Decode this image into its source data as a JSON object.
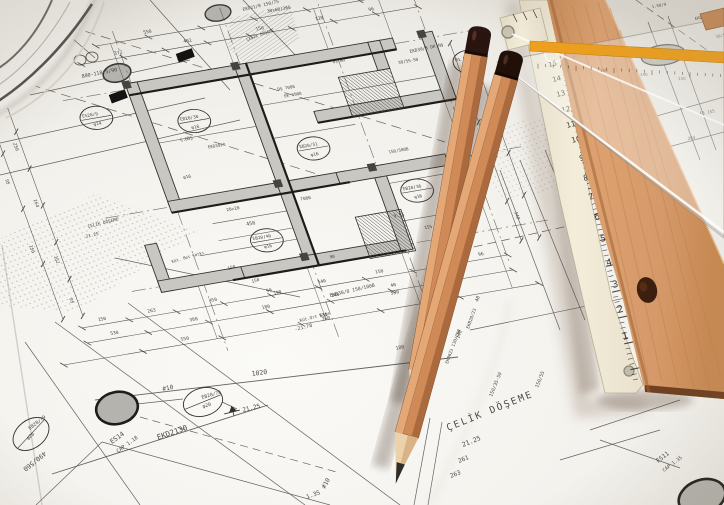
{
  "scene": {
    "type": "photograph",
    "subject": "architectural structural blueprint (Turkish) with two wooden pencils, a folding rule, a wooden straightedge and a transparent set square with yellow stripe"
  },
  "colors": {
    "paper": "#f5f3ef",
    "ink": "#3a3835",
    "wall_fill": "#c9c7c2",
    "column_fill": "#b9b7b1",
    "pencil_wood": "#cf8a57",
    "pencil_cap": "#261310",
    "graphite": "#35302c",
    "plank_wood": "#d69a6a",
    "plank_end": "#6f4022",
    "folding_rule": "#f0e9d8",
    "setsquare_stripe": "#efa01b"
  },
  "plan_labels": [
    {
      "t": "150",
      "x": -12,
      "y": 148,
      "r": 0,
      "s": 4.6
    },
    {
      "t": "263",
      "x": 38,
      "y": 148,
      "r": 0,
      "s": 4.6
    },
    {
      "t": "450",
      "x": 100,
      "y": 148,
      "r": 0,
      "s": 4.6
    },
    {
      "t": "90",
      "x": 158,
      "y": 148,
      "r": 0,
      "s": 4.6
    },
    {
      "t": "540",
      "x": 210,
      "y": 148,
      "r": 0,
      "s": 4.6
    },
    {
      "t": "150",
      "x": 268,
      "y": 148,
      "r": 0,
      "s": 4.6
    },
    {
      "t": "263",
      "x": 322,
      "y": 148,
      "r": 0,
      "s": 4.6
    },
    {
      "t": "96",
      "x": 372,
      "y": 148,
      "r": 0,
      "s": 4.6
    },
    {
      "t": "530",
      "x": -5,
      "y": 164,
      "r": 0,
      "s": 4.6
    },
    {
      "t": "360",
      "x": 75,
      "y": 164,
      "r": 0,
      "s": 4.6
    },
    {
      "t": "180",
      "x": 148,
      "y": 164,
      "r": 0,
      "s": 4.6
    },
    {
      "t": "140",
      "x": 218,
      "y": 164,
      "r": 0,
      "s": 4.6
    },
    {
      "t": "40",
      "x": 278,
      "y": 164,
      "r": 0,
      "s": 4.6
    },
    {
      "t": "130",
      "x": 332,
      "y": 164,
      "r": 0,
      "s": 4.6
    },
    {
      "t": "550",
      "x": 60,
      "y": 182,
      "r": 0,
      "s": 4.6
    },
    {
      "t": "530",
      "x": 200,
      "y": 182,
      "r": 0,
      "s": 4.6
    },
    {
      "t": "263",
      "x": 330,
      "y": 182,
      "r": 0,
      "s": 4.6
    },
    {
      "t": "372",
      "x": 95,
      "y": -116,
      "r": 0,
      "s": 4.6
    },
    {
      "t": "402",
      "x": 165,
      "y": -116,
      "r": 0,
      "s": 4.6
    },
    {
      "t": "150",
      "x": 238,
      "y": -116,
      "r": 0,
      "s": 4.6
    },
    {
      "t": "120",
      "x": 298,
      "y": -116,
      "r": 0,
      "s": 4.6
    },
    {
      "t": "96",
      "x": 352,
      "y": -116,
      "r": 0,
      "s": 4.6
    },
    {
      "t": "550",
      "x": 130,
      "y": -132,
      "r": 0,
      "s": 4.6
    },
    {
      "t": "30x60/260",
      "x": 255,
      "y": -132,
      "r": 0,
      "s": 4.4
    },
    {
      "t": "250",
      "x": -32,
      "y": -45,
      "r": 90,
      "s": 4.6
    },
    {
      "t": "164",
      "x": -32,
      "y": 15,
      "r": 90,
      "s": 4.6
    },
    {
      "t": "162",
      "x": -32,
      "y": 75,
      "r": 90,
      "s": 4.6
    },
    {
      "t": "95",
      "x": -32,
      "y": 120,
      "r": 90,
      "s": 4.6
    },
    {
      "t": "95",
      "x": -52,
      "y": -10,
      "r": 90,
      "s": 4.6
    },
    {
      "t": "150",
      "x": -52,
      "y": 60,
      "r": 90,
      "s": 4.6
    },
    {
      "t": "9.5",
      "x": 421,
      "y": -25,
      "r": 90,
      "s": 4.6
    },
    {
      "t": "155",
      "x": 421,
      "y": 45,
      "r": 90,
      "s": 4.6
    },
    {
      "t": "140",
      "x": 421,
      "y": 110,
      "r": 90,
      "s": 4.6
    },
    {
      "t": "450",
      "x": 162,
      "y": 78,
      "r": 0,
      "s": 5
    },
    {
      "t": "20x20",
      "x": 148,
      "y": 60,
      "r": 0,
      "s": 4.4
    },
    {
      "t": "DŞ 7008",
      "x": 238,
      "y": -52,
      "r": 0,
      "s": 4.2
    },
    {
      "t": "EK 7008",
      "x": 242,
      "y": -44,
      "r": 0,
      "s": 4.2
    },
    {
      "t": "150/300B",
      "x": 322,
      "y": 30,
      "r": 0,
      "s": 4.2
    },
    {
      "t": "30/55-50",
      "x": 362,
      "y": -58,
      "r": 0,
      "s": 4.2
    },
    {
      "t": "Ç.DÖŞ",
      "x": 128,
      "y": -18,
      "r": 0,
      "s": 4.2
    },
    {
      "t": "EKD30/8",
      "x": 152,
      "y": -6,
      "r": 0,
      "s": 4.2
    },
    {
      "t": "DŞ.NO",
      "x": 300,
      "y": -70,
      "r": 0,
      "s": 4
    },
    {
      "t": "9.55",
      "x": 305,
      "y": 95,
      "r": 0,
      "s": 4.4
    },
    {
      "t": "7080",
      "x": 222,
      "y": 62,
      "r": 0,
      "s": 4.4
    },
    {
      "t": "φ16",
      "x": 118,
      "y": 20,
      "r": 0,
      "s": 4.4
    },
    {
      "t": "155",
      "x": 330,
      "y": 112,
      "r": 0,
      "s": 4.4
    },
    {
      "t": "90",
      "x": 230,
      "y": 125,
      "r": 0,
      "s": 4.2
    }
  ],
  "plan_tags": [
    {
      "l1": "EB20/30",
      "l2": "φ16",
      "x": 148,
      "y": -36
    },
    {
      "l1": "EB20/31",
      "l2": "φ16",
      "x": 252,
      "y": 12
    },
    {
      "l1": "EB20/36",
      "l2": "φ16",
      "x": 336,
      "y": 72
    },
    {
      "l1": "ES20/9",
      "l2": "φ14",
      "x": 56,
      "y": -56
    },
    {
      "l1": "M1 P",
      "l2": "",
      "x": 430,
      "y": -48
    },
    {
      "l1": "EB20/40",
      "l2": "φ16",
      "x": 176,
      "y": 96
    }
  ],
  "sheet_labels": [
    {
      "t": "ÇELİK DÖŞEME",
      "x": 448,
      "y": 431,
      "r": -22,
      "s": 9.5,
      "ls": 2
    },
    {
      "t": "21.25",
      "x": 463,
      "y": 447,
      "r": -22,
      "s": 6.5,
      "ls": 0
    },
    {
      "t": "261",
      "x": 459,
      "y": 463,
      "r": -22,
      "s": 6,
      "ls": 0
    },
    {
      "t": "263",
      "x": 451,
      "y": 478,
      "r": -22,
      "s": 6,
      "ls": 0
    },
    {
      "t": "1020",
      "x": 252,
      "y": 376,
      "r": -8,
      "s": 6.5,
      "ls": 0
    },
    {
      "t": "EKD2130",
      "x": 158,
      "y": 440,
      "r": -19,
      "s": 7.5,
      "ls": 0
    },
    {
      "t": "ES14",
      "x": 112,
      "y": 444,
      "r": -36,
      "s": 6.5,
      "ls": 0
    },
    {
      "t": "CAP 1.18",
      "x": 118,
      "y": 453,
      "r": -36,
      "s": 5.2,
      "ls": 0
    },
    {
      "t": "#10",
      "x": 163,
      "y": 391,
      "r": -12,
      "s": 6,
      "ls": 0
    },
    {
      "t": "#10",
      "x": 325,
      "y": 489,
      "r": -62,
      "s": 6,
      "ls": 0
    },
    {
      "t": "1.35",
      "x": 307,
      "y": 499,
      "r": -20,
      "s": 6,
      "ls": 0
    },
    {
      "t": "21.25",
      "x": 243,
      "y": 412,
      "r": -14,
      "s": 6,
      "ls": 0
    },
    {
      "t": "490/560",
      "x": 44,
      "y": 451,
      "r": 141,
      "s": 6.5,
      "ls": 0
    },
    {
      "t": "EB20/78",
      "x": 202,
      "y": 399,
      "r": -16,
      "s": 4.8,
      "ls": 0
    },
    {
      "t": "φ20",
      "x": 203,
      "y": 408,
      "r": -16,
      "s": 4.8,
      "ls": 0
    },
    {
      "t": "EB20/79",
      "x": 30,
      "y": 430,
      "r": -38,
      "s": 4.8,
      "ls": 0
    },
    {
      "t": "φ20",
      "x": 28,
      "y": 440,
      "r": -38,
      "s": 4.8,
      "ls": 0
    },
    {
      "t": "ES11",
      "x": 658,
      "y": 463,
      "r": -37,
      "s": 6,
      "ls": 0
    },
    {
      "t": "CAP 1.35",
      "x": 664,
      "y": 472,
      "r": -37,
      "s": 4.8,
      "ls": 0
    },
    {
      "t": "-21.78",
      "x": 295,
      "y": 331,
      "r": -14,
      "s": 5,
      "ls": 0
    },
    {
      "t": "Küt.Ort Kats",
      "x": 300,
      "y": 322,
      "r": -14,
      "s": 4.3,
      "ls": 0
    },
    {
      "t": "EKD30/8 150/100B",
      "x": 330,
      "y": 297,
      "r": -13,
      "s": 4.8,
      "ls": 0
    },
    {
      "t": "530",
      "x": 391,
      "y": 295,
      "r": -13,
      "s": 4.8,
      "ls": 0
    },
    {
      "t": "360",
      "x": 322,
      "y": 321,
      "r": -13,
      "s": 4.8,
      "ls": 0
    },
    {
      "t": "180",
      "x": 396,
      "y": 350,
      "r": -13,
      "s": 4.8,
      "ls": 0
    },
    {
      "t": "140",
      "x": 459,
      "y": 339,
      "r": -70,
      "s": 4.8,
      "ls": 0
    },
    {
      "t": "40",
      "x": 478,
      "y": 302,
      "r": -70,
      "s": 4.8,
      "ls": 0
    },
    {
      "t": "EKB20/23",
      "x": 469,
      "y": 329,
      "r": -70,
      "s": 4.4,
      "ls": 0
    },
    {
      "t": "EKB023 130/250",
      "x": 448,
      "y": 364,
      "r": -70,
      "s": 4.3,
      "ls": 0
    },
    {
      "t": "130",
      "x": 428,
      "y": 377,
      "r": -70,
      "s": 4.8,
      "ls": 0
    },
    {
      "t": "800-118.5/90",
      "x": 82,
      "y": 78,
      "r": -11,
      "s": 5,
      "ls": 0
    },
    {
      "t": "EKD21/8 150/75",
      "x": 243,
      "y": 11,
      "r": -13,
      "s": 4.4,
      "ls": 0
    },
    {
      "t": "ÇELİK DÖŞEME",
      "x": 247,
      "y": 41,
      "r": -20,
      "s": 4,
      "ls": 0
    },
    {
      "t": "EKD30/8 DK.Nş",
      "x": 410,
      "y": 53,
      "r": -12,
      "s": 4.4,
      "ls": 0
    },
    {
      "t": "ÇELİK DÖŞEME",
      "x": 88,
      "y": 228,
      "r": -14,
      "s": 4.4,
      "ls": 0
    },
    {
      "t": "21.25",
      "x": 86,
      "y": 238,
      "r": -14,
      "s": 4.4,
      "ls": 0
    },
    {
      "t": "150/35-50",
      "x": 492,
      "y": 397,
      "r": -68,
      "s": 4.8,
      "ls": 0
    },
    {
      "t": "150/55",
      "x": 538,
      "y": 388,
      "r": -68,
      "s": 4.8,
      "ls": 0
    },
    {
      "t": "Küt. Bet Katkı",
      "x": 172,
      "y": 263,
      "r": -16,
      "s": 4,
      "ls": 0
    },
    {
      "t": "150",
      "x": 228,
      "y": 270,
      "r": -16,
      "s": 4.4,
      "ls": 0
    },
    {
      "t": "150",
      "x": 252,
      "y": 283,
      "r": -16,
      "s": 4.4,
      "ls": 0
    },
    {
      "t": "190",
      "x": 274,
      "y": 295,
      "r": -16,
      "s": 4.4,
      "ls": 0
    },
    {
      "t": "1,75",
      "x": 608,
      "y": 360,
      "r": -80,
      "s": 4.6,
      "ls": 0
    },
    {
      "t": "1.50/9",
      "x": 652,
      "y": 8,
      "r": -10,
      "s": 4,
      "ls": 0
    },
    {
      "t": "EKD/5",
      "x": 695,
      "y": 20,
      "r": -10,
      "s": 4,
      "ls": 0
    },
    {
      "t": "30/55",
      "x": 716,
      "y": 38,
      "r": -10,
      "s": 4,
      "ls": 0
    },
    {
      "t": "EŞ 155",
      "x": 700,
      "y": 115,
      "r": -10,
      "s": 4.2,
      "ls": 0
    },
    {
      "t": "263",
      "x": 688,
      "y": 140,
      "r": -10,
      "s": 4.2,
      "ls": 0
    }
  ],
  "folding_rule_numbers": [
    {
      "t": "16",
      "x": 546,
      "y": 52,
      "s": 6.5
    },
    {
      "t": "15",
      "x": 549,
      "y": 67,
      "s": 6.6
    },
    {
      "t": "14",
      "x": 553,
      "y": 82,
      "s": 6.8
    },
    {
      "t": "13",
      "x": 557,
      "y": 97,
      "s": 7
    },
    {
      "t": "12",
      "x": 562,
      "y": 113,
      "s": 7.2
    },
    {
      "t": "11",
      "x": 567,
      "y": 128,
      "s": 7.4
    },
    {
      "t": "10",
      "x": 572,
      "y": 143,
      "s": 7.6
    },
    {
      "t": "9",
      "x": 580,
      "y": 161,
      "s": 7.8
    },
    {
      "t": "8",
      "x": 584,
      "y": 181,
      "s": 8
    },
    {
      "t": "7",
      "x": 589,
      "y": 200,
      "s": 8.3
    },
    {
      "t": "6",
      "x": 595,
      "y": 220,
      "s": 8.6
    },
    {
      "t": "5",
      "x": 601,
      "y": 242,
      "s": 8.9
    },
    {
      "t": "4",
      "x": 607,
      "y": 266,
      "s": 9.2
    },
    {
      "t": "3",
      "x": 613,
      "y": 288,
      "s": 9.5
    },
    {
      "t": "2",
      "x": 618,
      "y": 313,
      "s": 9.8
    },
    {
      "t": "1",
      "x": 623,
      "y": 340,
      "s": 10
    }
  ],
  "setsquare_numbers": [
    {
      "t": "150",
      "x": 600,
      "y": 72
    },
    {
      "t": "140",
      "x": 640,
      "y": 76
    },
    {
      "t": "130",
      "x": 678,
      "y": 80
    }
  ]
}
